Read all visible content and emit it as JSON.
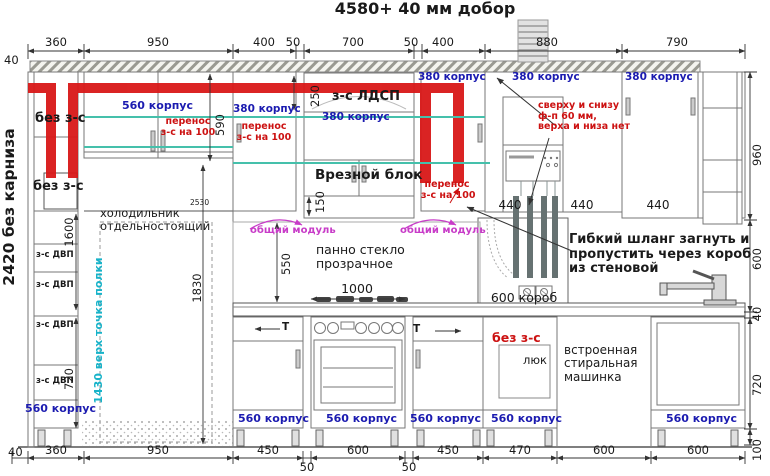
{
  "title": "4580+ 40 мм добор",
  "colors": {
    "dim_blue": "#1b1bb0",
    "note_red": "#cc1111",
    "module_magenta": "#c83cc8",
    "shelf_cyan": "#17b3c9",
    "pipe_red": "#d91818"
  },
  "dims": {
    "top_offset": "40",
    "top": [
      "360",
      "950",
      "400",
      "50",
      "700",
      "50",
      "400",
      "880",
      "790"
    ],
    "bottom_offset": "40",
    "bottom": [
      "360",
      "950",
      "450",
      "50",
      "600",
      "50",
      "450",
      "470",
      "600",
      "600"
    ],
    "right": [
      "960",
      "600",
      "40",
      "720",
      "100"
    ],
    "h590": "590",
    "h250": "250",
    "h150": "150",
    "h550": "550",
    "w1000": "1000",
    "h2530": "2530",
    "h1830": "1830",
    "h1600": "1600",
    "h720": "720",
    "w440": "440"
  },
  "labels": {
    "wall_height": "2420 без карниза",
    "no_zs": "без з-с",
    "cab560": "560 корпус",
    "cab380": "380 корпус",
    "perenos_line1": "перенос",
    "perenos_line2": "з-с на 100",
    "ldsp": "з-с ЛДСП",
    "vrez_block": "Врезной блок",
    "common_module": "общий модуль",
    "fridge_line1": "холодильник",
    "fridge_line2": "отдельностоящий",
    "dvp": "з-с ДВП",
    "shelf_note": "1430 верх точка полки",
    "facade_note1": "сверху и снизу",
    "facade_note2": "ф-п 60 мм,",
    "facade_note3": "верха и низа нет",
    "hose_note1": "Гибкий шланг загнуть и",
    "hose_note2": "пропустить через короб",
    "hose_note3": "из стеновой",
    "korob": "600 короб",
    "hatch_door": "люк",
    "washer_line1": "встроенная",
    "washer_line2": "стиральная",
    "washer_line3": "машинка",
    "glass_line1": "панно стекло",
    "glass_line2": "прозрачное",
    "drawer_t": "Т"
  }
}
